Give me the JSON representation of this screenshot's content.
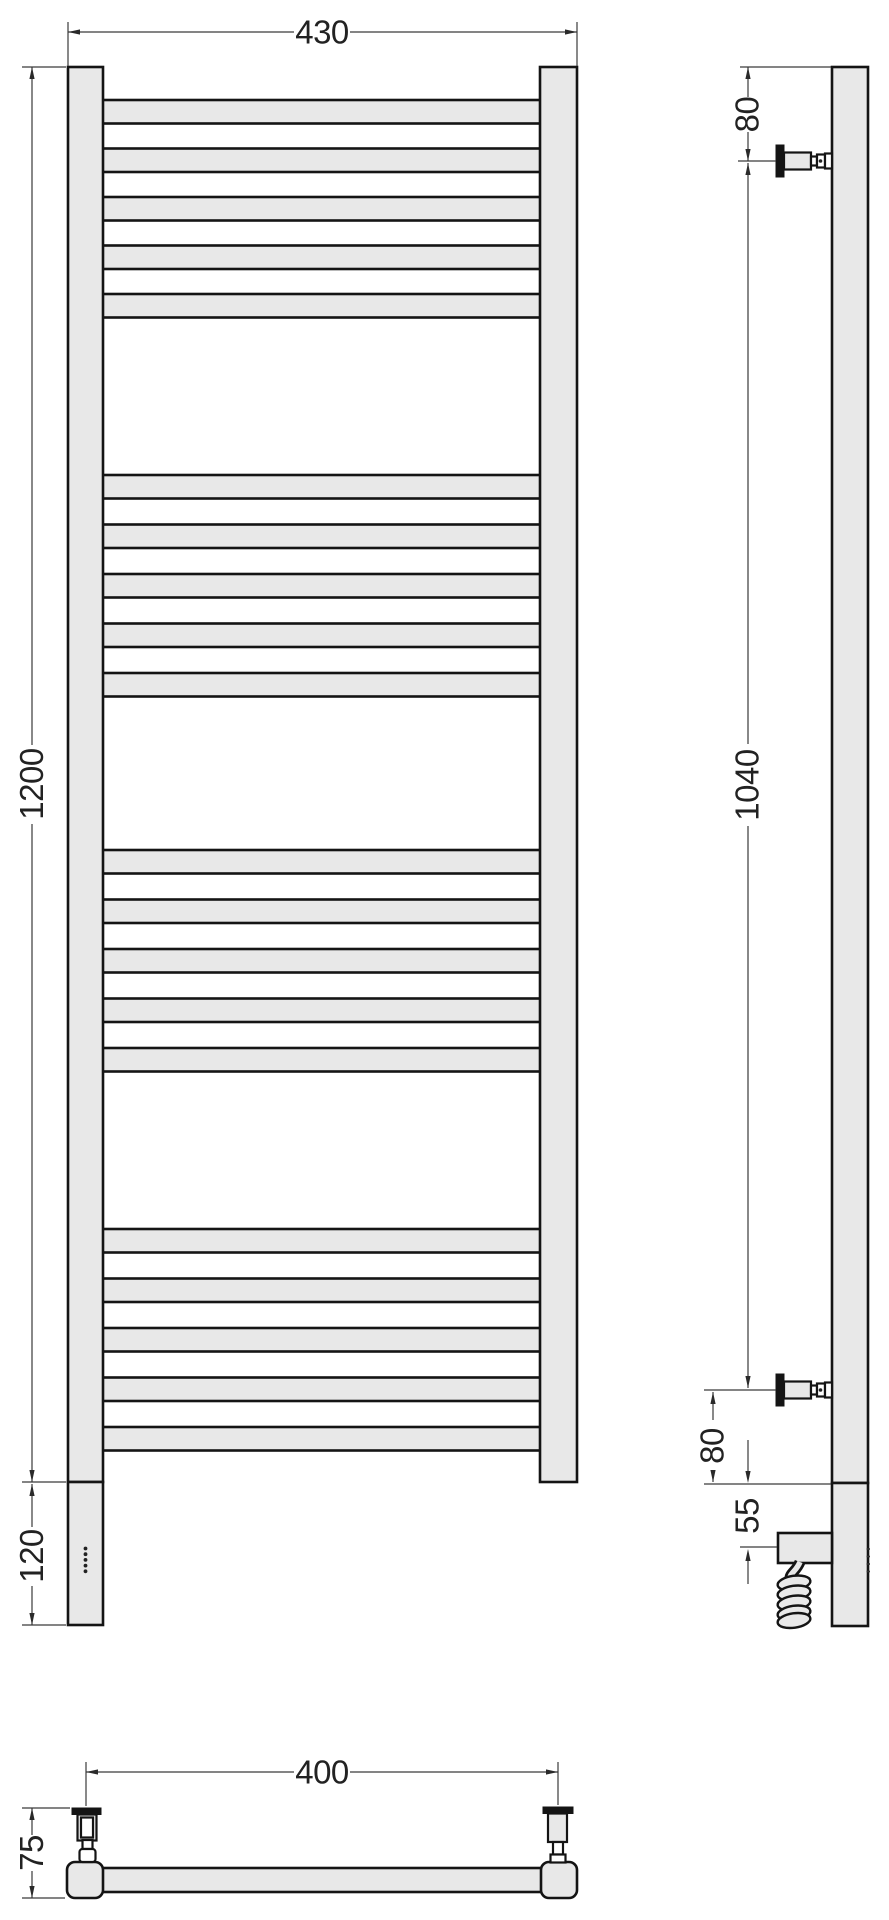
{
  "drawing": {
    "type": "technical-drawing",
    "subject": "ladder-towel-rail",
    "colors": {
      "part_fill": "#e8e8e8",
      "outline": "#141414",
      "dim_line": "#3a3a3a",
      "text": "#222222"
    },
    "dims": {
      "front_width": "430",
      "front_height": "1200",
      "front_bottom_section": "120",
      "side_top_offset": "80",
      "side_bracket_span": "1040",
      "side_bottom_offset": "80",
      "side_element_offset": "55",
      "bottom_bracket_spacing": "400",
      "bottom_wall_depth": "75"
    },
    "front_view": {
      "bar_tops": [
        100,
        148.5,
        197,
        245.5,
        294,
        475,
        524.5,
        574,
        623.5,
        673,
        850,
        899.5,
        949,
        998.5,
        1048,
        1229,
        1278.5,
        1328,
        1377.5,
        1427
      ],
      "bar_height": 23.5,
      "bar_x": 101,
      "bar_width": 441,
      "groups": 4,
      "bars_per_group": 5,
      "control_dot_count": 5
    }
  }
}
